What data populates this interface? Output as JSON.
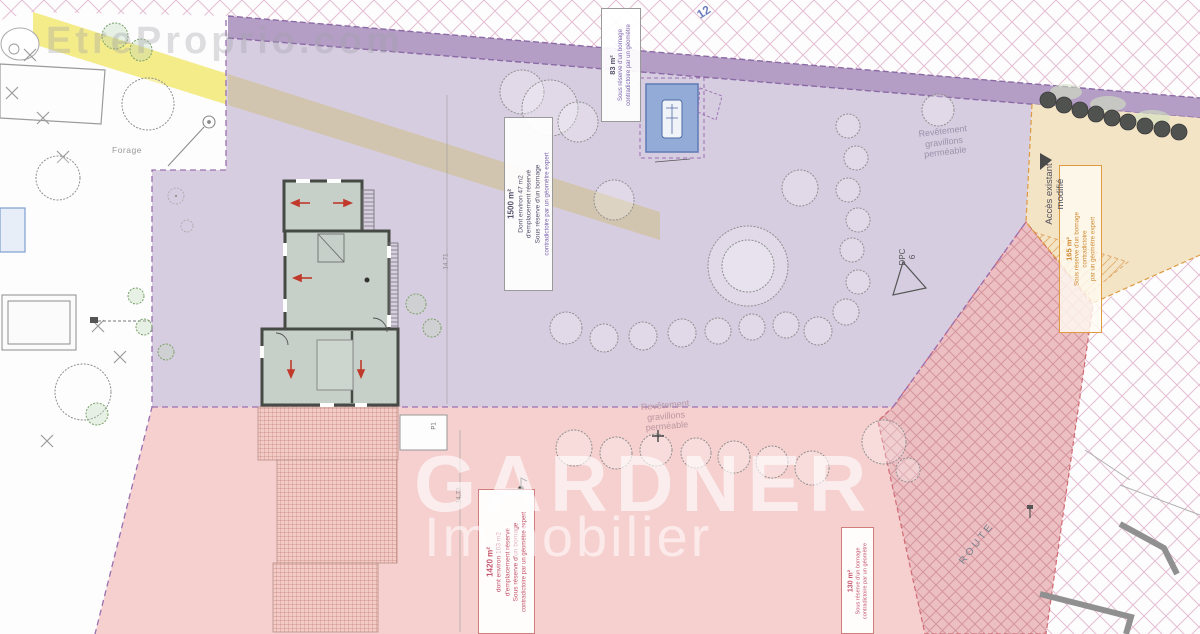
{
  "watermarks": {
    "site": "EtreProprio.com",
    "brand": "GARDNER",
    "brand_sub": "Immobilier"
  },
  "annotations": {
    "area_main": {
      "title": "1500 m²",
      "lines": [
        "Dont environ 47 m2",
        "d'emplacement réservé",
        "Sous réserve d'un bornage"
      ],
      "note": "contradictoire par un géomètre expert"
    },
    "area_top": {
      "title": "83 m²",
      "lines": [
        "Sous réserve d'un bornage",
        "contradictoire par un géomètre"
      ]
    },
    "area_bottom": {
      "title": "1420 m²",
      "lines": [
        "dont environ 103 m2",
        "d'emplacement réservé",
        "Sous réserve d'un bornage"
      ],
      "note": "contradictoire par un géomètre expert"
    },
    "area_road": {
      "title": "130 m²",
      "lines": [
        "Sous réserve d'un bornage",
        "contradictoire par un géomètre"
      ]
    },
    "area_access": {
      "title": "165 m²",
      "lines": [
        "Sous réserve d'un bornage",
        "contradictoire",
        "par un géomètre expert"
      ]
    },
    "access_modified": {
      "lines": [
        "Accès existant",
        "modifié"
      ]
    },
    "gravel": {
      "lines": [
        "Revêtement",
        "gravillons",
        "perméable"
      ]
    },
    "dpc": {
      "lines": [
        "DPC",
        "6"
      ]
    },
    "forage": "Forage",
    "route": "ROUTE",
    "parcel_number": "12",
    "p1": "P1",
    "dims": [
      "14,71",
      "14,73"
    ]
  },
  "colors": {
    "parcel_purple": "#d7cde1",
    "zone_pink": "#f5d0cf",
    "path_strip": "#b49ec5",
    "band_yellow": "#f3e97f",
    "zone_beige": "#f4e4c6",
    "pool_blue": "#93acd7",
    "house_fill": "#c6cfc8",
    "accent_red": "#c4566c",
    "accent_orange": "#cf8b33",
    "accent_purple": "#7b63ad"
  }
}
